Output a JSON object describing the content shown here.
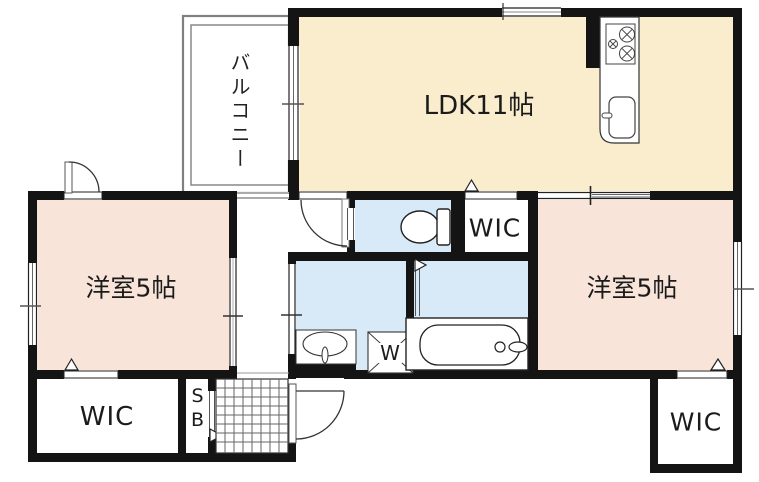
{
  "plan_title": "apartment-floor-plan",
  "rooms": {
    "balcony": {
      "label": "バルコニー"
    },
    "ldk": {
      "label": "LDK11帖"
    },
    "bedroom_left": {
      "label": "洋室5帖"
    },
    "bedroom_right": {
      "label": "洋室5帖"
    },
    "wic_middle": {
      "label": "WIC"
    },
    "wic_bottom_left": {
      "label": "WIC"
    },
    "wic_bottom_right": {
      "label": "WIC"
    },
    "shoe_box": {
      "label": "SB"
    },
    "laundry": {
      "washer_label": "W"
    }
  },
  "fixtures": [
    "toilet",
    "bathtub",
    "washbasin",
    "washing-machine",
    "gas-stove",
    "kitchen-sink",
    "entrance-door"
  ],
  "colors": {
    "ldk_floor": "#FAEDCD",
    "bedroom_floor": "#F9E4DA",
    "wet_area_floor": "#D8EAF8",
    "wall": "#141414",
    "balcony_rail": "#808080",
    "tile_line": "#666666"
  }
}
